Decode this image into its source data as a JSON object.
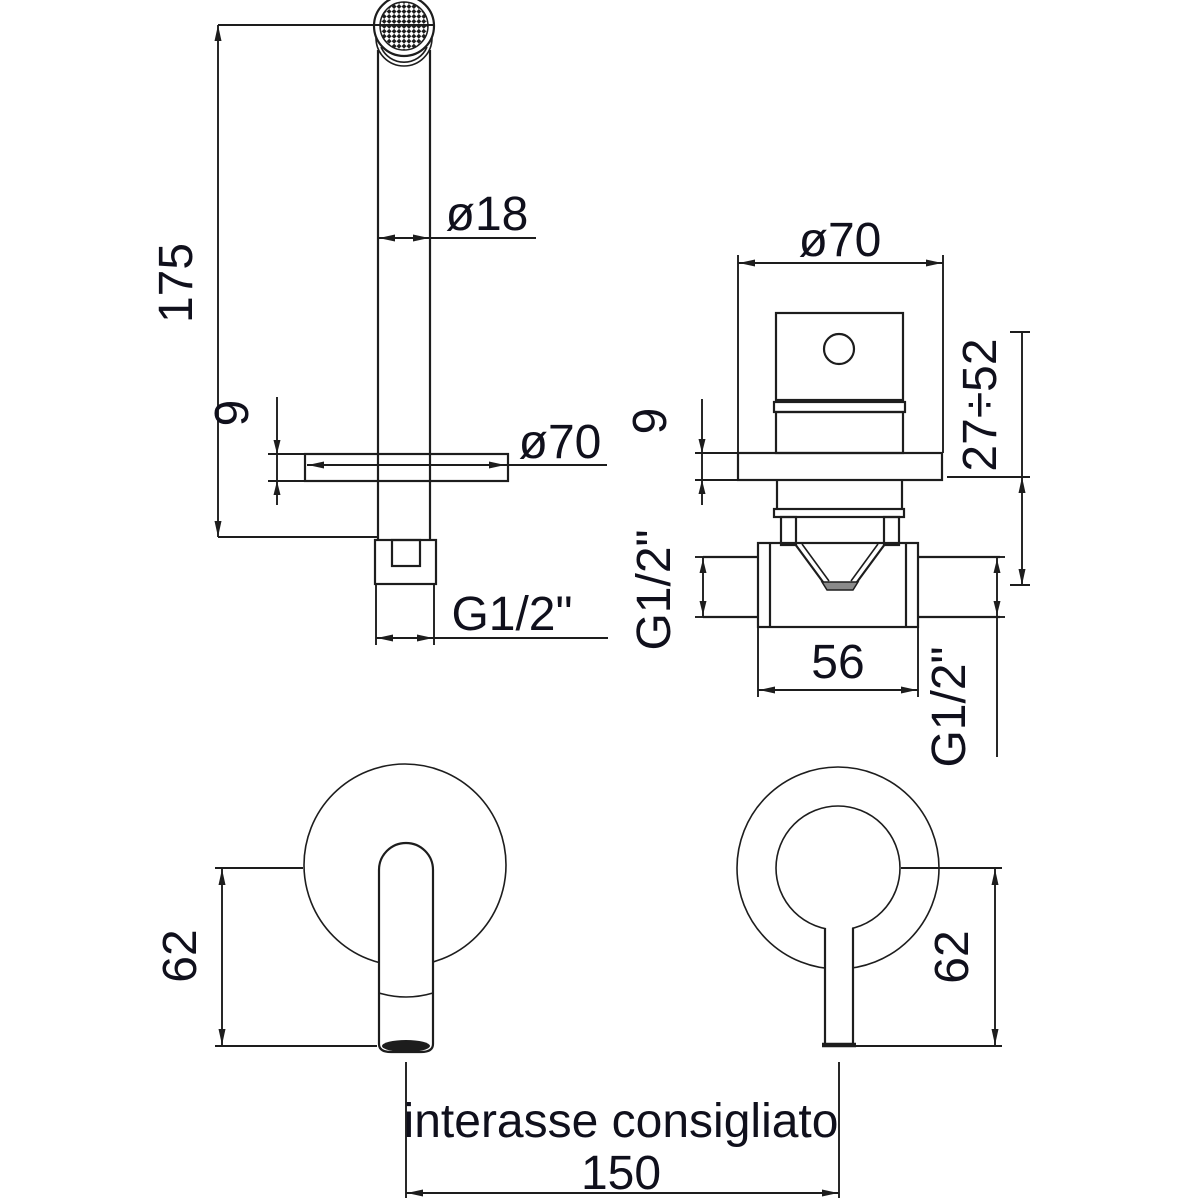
{
  "colors": {
    "line": "#1d1d1d",
    "text": "#10101c",
    "background": "#ffffff"
  },
  "labels": {
    "spout_height": "175",
    "spout_diameter": "ø18",
    "spout_flange_diameter": "ø70",
    "spout_flange_thickness": "9",
    "spout_thread": "G1/2\"",
    "mixer_plate_diameter": "ø70",
    "mixer_plate_thickness": "9",
    "mixer_wall_depth_range": "27÷52",
    "mixer_inlet_thread": "G1/2\"",
    "mixer_body_length": "56",
    "mixer_outlet_thread": "G1/2\"",
    "spout_front_drop": "62",
    "mixer_front_drop": "62",
    "spacing_caption": "interasse consigliato",
    "spacing_value": "150"
  }
}
